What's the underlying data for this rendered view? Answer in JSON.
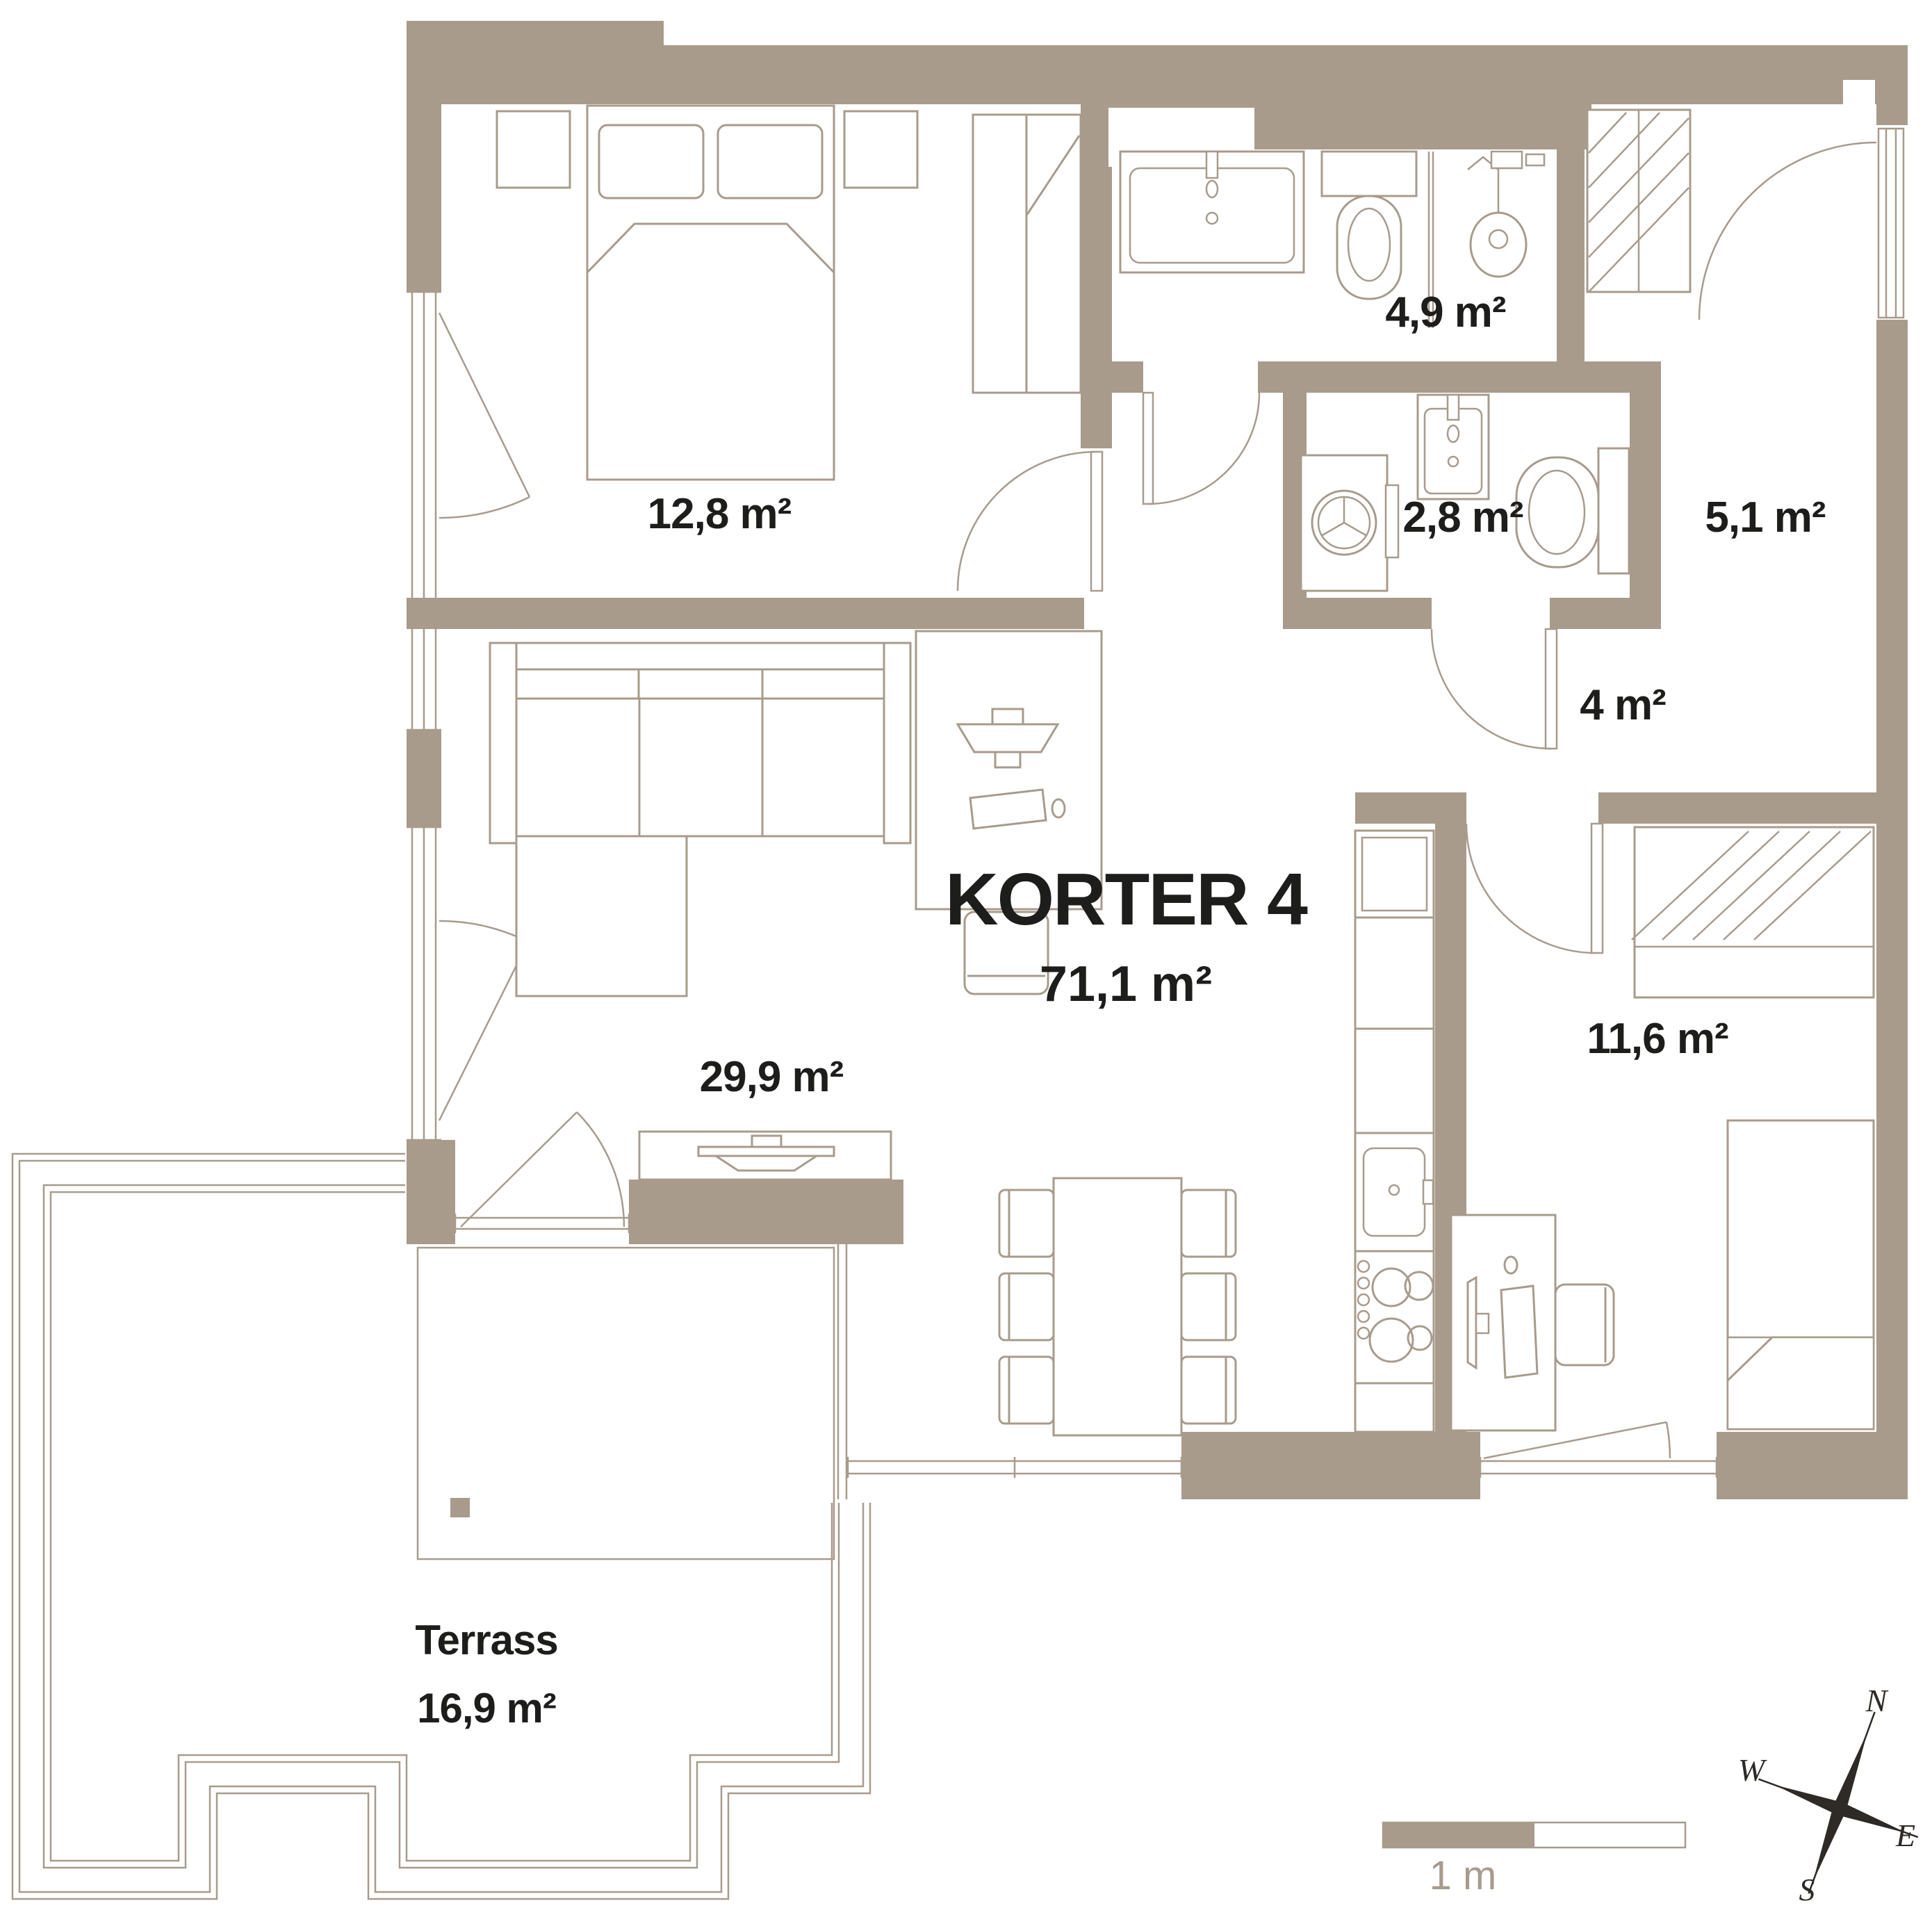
{
  "title": {
    "name": "KORTER 4",
    "area": "71,1 m²"
  },
  "rooms": {
    "bedroom1": {
      "label": "12,8 m²"
    },
    "bathroom": {
      "label": "4,9 m²"
    },
    "wc": {
      "label": "2,8 m²"
    },
    "entry": {
      "label": "5,1 m²"
    },
    "hall": {
      "label": "4 m²"
    },
    "living": {
      "label": "29,9 m²"
    },
    "bedroom2": {
      "label": "11,6 m²"
    }
  },
  "terrace": {
    "name": "Terrass",
    "area": "16,9 m²"
  },
  "scale_bar": {
    "label": "1 m"
  },
  "compass": {
    "n": "N",
    "e": "E",
    "s": "S",
    "w": "W"
  },
  "colors": {
    "wall": "#a89b8c",
    "ink": "#1d1d1b",
    "compass": "#2e2a26"
  }
}
